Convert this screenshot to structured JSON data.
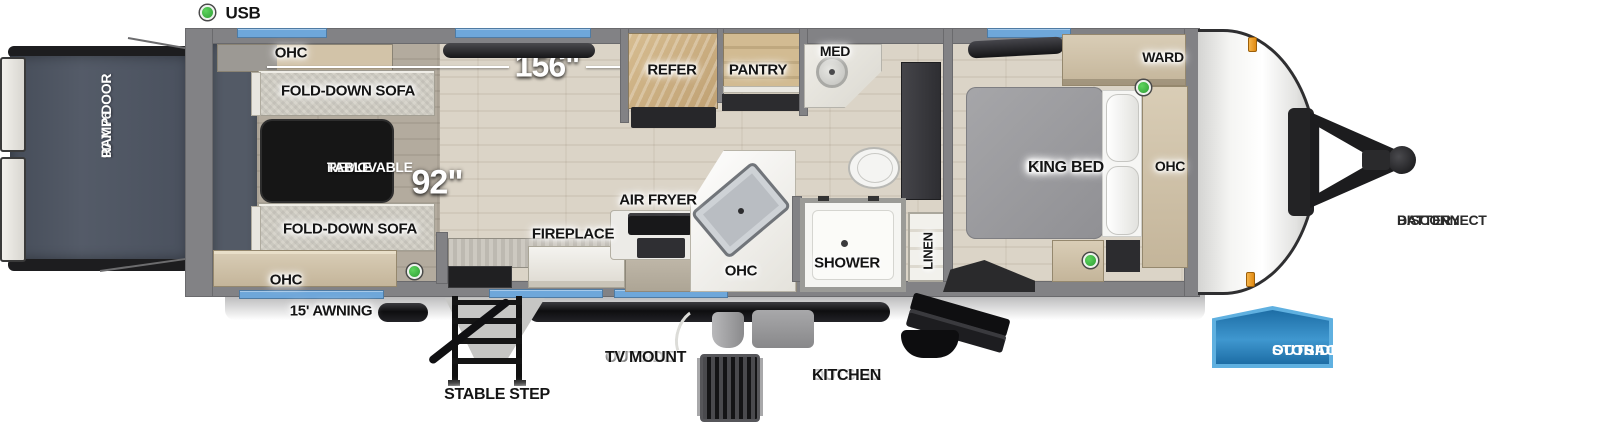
{
  "legend": {
    "usb": "USB"
  },
  "dims": {
    "w156": "156\"",
    "w92": "92\""
  },
  "garage": {
    "ohc_top": "OHC",
    "sofa_top": "FOLD-DOWN SOFA",
    "table_l1": "REMOVABLE",
    "table_l2": "TABLE",
    "sofa_bottom": "FOLD-DOWN SOFA",
    "ohc_bottom": "OHC",
    "ramp_l1": "90 X 76",
    "ramp_l2": "RAMP DOOR"
  },
  "kitchen": {
    "refer": "REFER",
    "pantry": "PANTRY",
    "air_fryer": "AIR FRYER",
    "fireplace": "FIREPLACE",
    "ohc": "OHC"
  },
  "bath": {
    "med": "MED",
    "shower": "SHOWER",
    "linen": "LINEN"
  },
  "bedroom": {
    "bed_l1": "RV",
    "bed_l2": "KING BED",
    "ward": "WARD",
    "ohc": "OHC"
  },
  "exterior": {
    "awning": "15' AWNING",
    "stable_step": "STABLE STEP",
    "tv_mount_l1": "OUTSIDE",
    "tv_mount_l2": "TV MOUNT",
    "kitchen_l1": "OUTSIDE",
    "kitchen_l2": "KITCHEN",
    "battery_l1": "BATTERY",
    "battery_l2": "DISCONNECT",
    "storage_l1": "OUTSIDE",
    "storage_l2": "STORAGE"
  },
  "colors": {
    "window_blue": "#6ea7da",
    "badge_fill_blue": "#2f85bd",
    "badge_border_blue": "#5fb0e0",
    "usb_green": "#3cb043",
    "clearance_marker_orange": "#e8941c",
    "ramp_door_slate": "#4e5562",
    "wall_gray": "#828285"
  }
}
